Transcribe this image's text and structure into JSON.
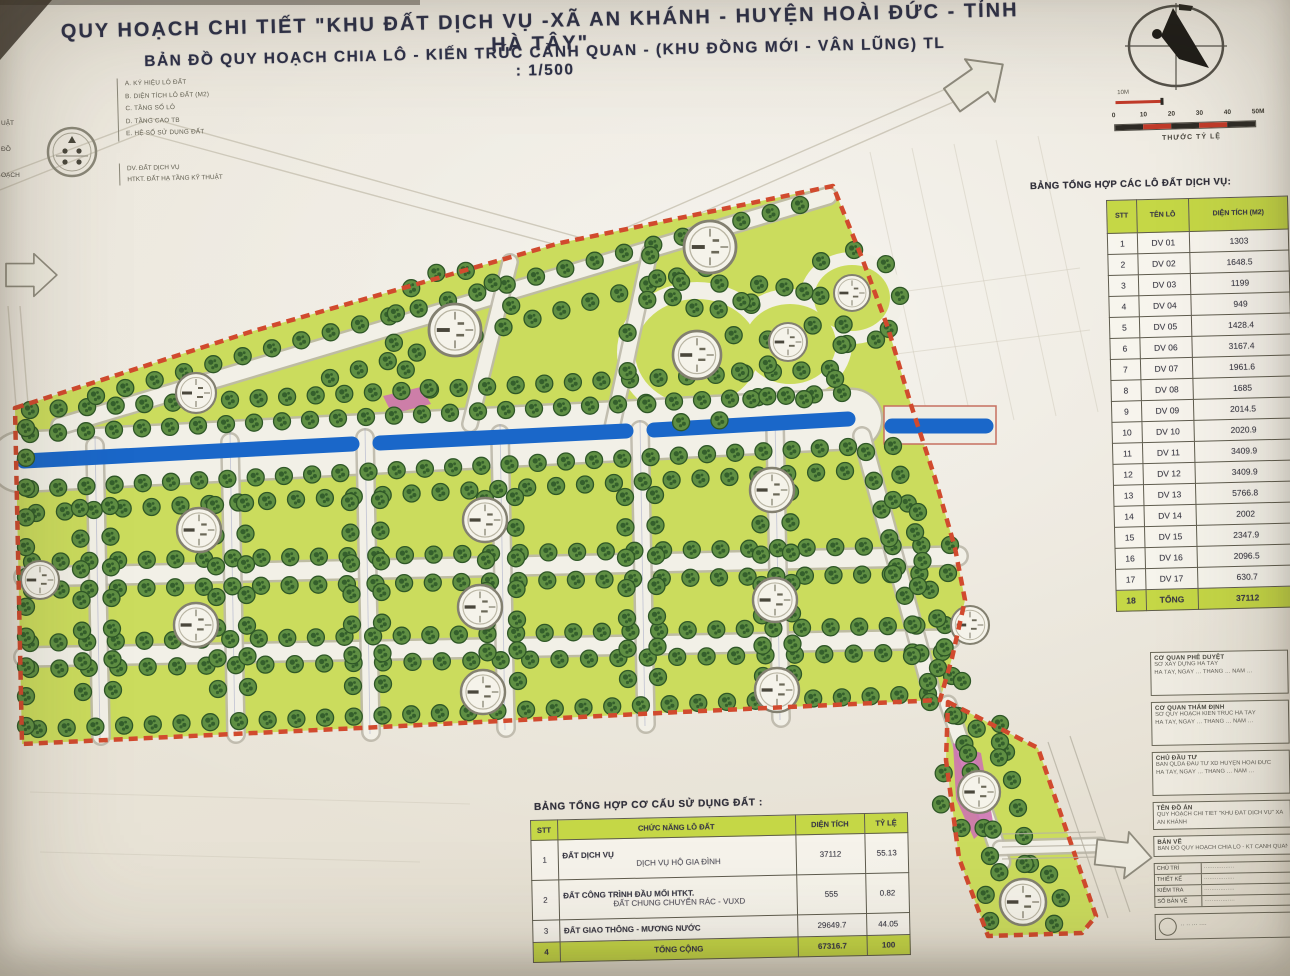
{
  "title": {
    "line1": "QUY HOẠCH CHI TIẾT \"KHU ĐẤT DỊCH VỤ -XÃ AN KHÁNH - HUYỆN HOÀI ĐỨC - TỈNH HÀ TÂY\"",
    "line2": "BẢN ĐỒ QUY HOẠCH CHIA LÔ - KIẾN TRÚC CẢNH QUAN - (KHU ĐỒNG MỚI - VÂN LŨNG)  TL : 1/500"
  },
  "legend": {
    "items": [
      "A. KÝ HIỆU LÔ ĐẤT",
      "B. DIỆN TÍCH LÔ ĐẤT (M2)",
      "C. TẦNG SỐ LÔ",
      "D. TẦNG CAO TB",
      "E. HỆ SỐ SỬ DỤNG ĐẤT"
    ],
    "notes": [
      "DV. ĐẤT DỊCH VỤ",
      "HTKT. ĐẤT HẠ TẦNG KỸ THUẬT"
    ],
    "edge_fragments": [
      "UẬT",
      "ĐỒ",
      "OẠCH"
    ]
  },
  "scalebar": {
    "small_label": "10M",
    "ticks": [
      "0",
      "10",
      "20",
      "30",
      "40",
      "50M"
    ],
    "caption": "THƯỚC TỶ LỆ"
  },
  "right_table": {
    "title": "BẢNG TỔNG HỢP CÁC LÔ ĐẤT DỊCH VỤ:",
    "columns": [
      "STT",
      "TÊN LÔ",
      "DIỆN TÍCH (M2)"
    ],
    "rows": [
      [
        "1",
        "DV 01",
        "1303"
      ],
      [
        "2",
        "DV 02",
        "1648.5"
      ],
      [
        "3",
        "DV 03",
        "1199"
      ],
      [
        "4",
        "DV 04",
        "949"
      ],
      [
        "5",
        "DV 05",
        "1428.4"
      ],
      [
        "6",
        "DV 06",
        "3167.4"
      ],
      [
        "7",
        "DV 07",
        "1961.6"
      ],
      [
        "8",
        "DV 08",
        "1685"
      ],
      [
        "9",
        "DV 09",
        "2014.5"
      ],
      [
        "10",
        "DV 10",
        "2020.9"
      ],
      [
        "11",
        "DV 11",
        "3409.9"
      ],
      [
        "12",
        "DV 12",
        "3409.9"
      ],
      [
        "13",
        "DV 13",
        "5766.8"
      ],
      [
        "14",
        "DV 14",
        "2002"
      ],
      [
        "15",
        "DV 15",
        "2347.9"
      ],
      [
        "16",
        "DV 16",
        "2096.5"
      ],
      [
        "17",
        "DV 17",
        "630.7"
      ]
    ],
    "total_row": [
      "18",
      "TỔNG",
      "37112"
    ]
  },
  "bottom_table": {
    "title": "BẢNG TỔNG HỢP CƠ CẤU  SỬ DỤNG ĐẤT :",
    "columns": [
      "STT",
      "CHỨC NĂNG LÔ ĐẤT",
      "DIỆN TÍCH",
      "TỶ LỆ"
    ],
    "rows": [
      {
        "stt": "1",
        "label": "ĐẤT DỊCH VỤ",
        "sub": "DỊCH VỤ HỘ GIA ĐÌNH",
        "area": "37112",
        "pct": "55.13"
      },
      {
        "stt": "2",
        "label": "ĐẤT CÔNG TRÌNH ĐẦU MỐI HTKT.",
        "sub": "ĐẤT CHUNG CHUYỂN RÁC - VUXD",
        "area": "555",
        "pct": "0.82"
      },
      {
        "stt": "3",
        "label": "ĐẤT GIAO THÔNG - MƯƠNG NƯỚC",
        "sub": "",
        "area": "29649.7",
        "pct": "44.05"
      }
    ],
    "total_row": {
      "stt": "4",
      "label": "TỔNG CỘNG",
      "area": "67316.7",
      "pct": "100"
    }
  },
  "title_block": {
    "sections": [
      {
        "h": "CƠ QUAN PHÊ DUYỆT",
        "l2": "SỞ XÂY DỰNG HÀ TÂY",
        "l3": "HÀ TÂY, NGÀY … THÁNG … NĂM …"
      },
      {
        "h": "CƠ QUAN THẨM ĐỊNH",
        "l2": "SỞ QUY HOẠCH KIẾN TRÚC HÀ TÂY",
        "l3": "HÀ TÂY, NGÀY … THÁNG … NĂM …"
      },
      {
        "h": "CHỦ ĐẦU TƯ",
        "l2": "BAN QLDA ĐẦU TƯ XD HUYỆN HOÀI ĐỨC",
        "l3": "HÀ TÂY, NGÀY … THÁNG … NĂM …"
      }
    ],
    "project": {
      "label": "TÊN ĐỒ ÁN",
      "value": "QUY HOẠCH CHI TIẾT \"KHU ĐẤT DỊCH VỤ\" XÃ AN KHÁNH"
    },
    "drawing": {
      "label": "BẢN VẼ",
      "value": "BẢN ĐỒ QUY HOẠCH CHIA LÔ - KT CẢNH QUAN"
    },
    "staff": [
      [
        "CHỦ TRÌ",
        "·················"
      ],
      [
        "THIẾT KẾ",
        "·················"
      ],
      [
        "KIỂM TRA",
        "·················"
      ],
      [
        "SỐ BẢN VẼ",
        "·················"
      ]
    ],
    "footer": "·· ·· ··· ····"
  },
  "colors": {
    "lot_green": "#cbdd58",
    "canal_blue": "#1767cd",
    "boundary_red": "#d6492c",
    "tree_green": "#5e9040",
    "pink": "#cf6fb4",
    "table_green": "#c5d746",
    "road_white": "#f2f0e7",
    "casing": "#bdb9aa",
    "faint": "#cfc9ba"
  },
  "map": {
    "outside_lines": [
      [
        598,
        240,
        948,
        88
      ],
      [
        612,
        252,
        958,
        100
      ],
      [
        150,
        118,
        596,
        242
      ],
      [
        140,
        132,
        590,
        254
      ],
      [
        0,
        176,
        148,
        120
      ],
      [
        0,
        190,
        140,
        134
      ],
      [
        8,
        306,
        16,
        406
      ],
      [
        20,
        306,
        28,
        404
      ]
    ],
    "grid_lines": [
      [
        870,
        152,
        930,
        428
      ],
      [
        912,
        148,
        972,
        424
      ],
      [
        954,
        144,
        1014,
        420
      ],
      [
        996,
        140,
        1056,
        416
      ],
      [
        1038,
        136,
        1098,
        412
      ],
      [
        840,
        300,
        1080,
        268
      ],
      [
        848,
        360,
        1090,
        330
      ],
      [
        30,
        792,
        470,
        804
      ],
      [
        40,
        852,
        420,
        862
      ]
    ],
    "parcels": [
      "15,408 250,332 560,243 833,186 862,258 888,328 912,408 935,478 955,548 965,600 952,658 940,700 680,712 360,728 22,744",
      "948,702 1038,748 1096,916 1082,933 988,936 959,858 946,760"
    ],
    "white_ovals": [
      [
        697,
        352,
        80,
        70
      ],
      [
        790,
        344,
        62,
        55
      ],
      [
        852,
        298,
        52,
        46
      ]
    ],
    "green_ovals": [
      [
        697,
        352,
        62,
        53
      ],
      [
        790,
        344,
        46,
        40
      ],
      [
        852,
        298,
        38,
        33
      ]
    ],
    "roads": [
      {
        "x1": 20,
        "y1": 462,
        "x2": 852,
        "y2": 419,
        "w": 58
      },
      {
        "x1": 24,
        "y1": 577,
        "x2": 958,
        "y2": 556,
        "w": 17
      },
      {
        "x1": 24,
        "y1": 657,
        "x2": 950,
        "y2": 639,
        "w": 17
      },
      {
        "x1": 60,
        "y1": 426,
        "x2": 828,
        "y2": 196,
        "w": 15
      },
      {
        "x1": 95,
        "y1": 446,
        "x2": 101,
        "y2": 736,
        "w": 15
      },
      {
        "x1": 230,
        "y1": 442,
        "x2": 236,
        "y2": 734,
        "w": 15
      },
      {
        "x1": 365,
        "y1": 438,
        "x2": 371,
        "y2": 732,
        "w": 15
      },
      {
        "x1": 500,
        "y1": 434,
        "x2": 506,
        "y2": 728,
        "w": 15
      },
      {
        "x1": 640,
        "y1": 430,
        "x2": 646,
        "y2": 724,
        "w": 15
      },
      {
        "x1": 775,
        "y1": 426,
        "x2": 781,
        "y2": 718,
        "w": 15
      },
      {
        "x1": 470,
        "y1": 424,
        "x2": 510,
        "y2": 262,
        "w": 13
      },
      {
        "x1": 612,
        "y1": 428,
        "x2": 650,
        "y2": 252,
        "w": 13
      },
      {
        "x1": 862,
        "y1": 436,
        "x2": 932,
        "y2": 694,
        "w": 15
      },
      {
        "x1": 948,
        "y1": 704,
        "x2": 1002,
        "y2": 862,
        "w": 14
      },
      {
        "x1": 1000,
        "y1": 848,
        "x2": 1100,
        "y2": 845,
        "w": 12
      }
    ],
    "lot_lines": [
      [
        95,
        436,
        100,
        738
      ],
      [
        230,
        432,
        235,
        736
      ],
      [
        365,
        428,
        370,
        734
      ],
      [
        500,
        424,
        505,
        730
      ],
      [
        640,
        420,
        645,
        726
      ],
      [
        775,
        416,
        780,
        720
      ]
    ],
    "canal_rect": {
      "x": 884,
      "y": 406,
      "w": 112,
      "h": 38
    },
    "canals": [
      [
        24,
        461,
        352,
        444
      ],
      [
        380,
        443,
        626,
        431
      ],
      [
        654,
        430,
        848,
        419
      ],
      [
        892,
        426,
        986,
        426
      ]
    ],
    "pink": [
      "383,396 421,387 431,404 392,414",
      "953,743 981,753 993,822 974,839 956,799"
    ],
    "tree_rows": [
      [
        30,
        434,
        842,
        393,
        30
      ],
      [
        30,
        410,
        830,
        369,
        29
      ],
      [
        30,
        489,
        848,
        447,
        30
      ],
      [
        36,
        513,
        845,
        471,
        29
      ],
      [
        32,
        562,
        950,
        545,
        33
      ],
      [
        32,
        590,
        948,
        573,
        33
      ],
      [
        30,
        643,
        945,
        625,
        33
      ],
      [
        30,
        669,
        942,
        652,
        32
      ],
      [
        38,
        729,
        928,
        694,
        32
      ],
      [
        26,
        428,
        26,
        726,
        11
      ],
      [
        96,
        396,
        800,
        205,
        25
      ],
      [
        330,
        378,
        706,
        268,
        14
      ],
      [
        866,
        452,
        928,
        682,
        9
      ],
      [
        893,
        446,
        952,
        676,
        9
      ],
      [
        958,
        716,
        990,
        856,
        6
      ],
      [
        1000,
        724,
        1030,
        864,
        6
      ],
      [
        930,
        702,
        1000,
        742,
        4
      ],
      [
        80,
        508,
        83,
        692,
        7
      ],
      [
        110,
        506,
        113,
        690,
        7
      ],
      [
        215,
        505,
        218,
        689,
        7
      ],
      [
        245,
        503,
        248,
        687,
        7
      ],
      [
        350,
        502,
        353,
        686,
        7
      ],
      [
        380,
        500,
        383,
        684,
        7
      ],
      [
        485,
        499,
        488,
        683,
        7
      ],
      [
        515,
        497,
        518,
        681,
        7
      ],
      [
        625,
        497,
        628,
        679,
        7
      ],
      [
        655,
        495,
        658,
        677,
        7
      ],
      [
        760,
        494,
        763,
        676,
        7
      ],
      [
        790,
        492,
        793,
        674,
        7
      ]
    ],
    "tree_rings": [
      [
        697,
        352,
        72,
        10,
        350,
        12
      ],
      [
        790,
        344,
        57,
        0,
        340,
        10
      ],
      [
        852,
        298,
        48,
        60,
        400,
        9
      ],
      [
        710,
        250,
        60,
        35,
        175,
        7
      ],
      [
        455,
        332,
        62,
        115,
        335,
        9
      ],
      [
        1023,
        902,
        38,
        150,
        395,
        7
      ],
      [
        979,
        792,
        40,
        70,
        300,
        6
      ]
    ],
    "trees_single": [
      [
        912,
        656
      ],
      [
        938,
        668
      ],
      [
        962,
        681
      ],
      [
        893,
        574
      ],
      [
        918,
        586
      ],
      [
        893,
        500
      ],
      [
        918,
        512
      ]
    ],
    "lot_circles": [
      [
        196,
        393,
        20
      ],
      [
        199,
        530,
        22
      ],
      [
        196,
        625,
        22
      ],
      [
        40,
        580,
        19
      ],
      [
        455,
        330,
        26
      ],
      [
        485,
        520,
        22
      ],
      [
        480,
        607,
        22
      ],
      [
        483,
        692,
        22
      ],
      [
        710,
        247,
        26
      ],
      [
        697,
        355,
        24
      ],
      [
        788,
        342,
        19
      ],
      [
        852,
        293,
        18
      ],
      [
        772,
        490,
        22
      ],
      [
        775,
        600,
        22
      ],
      [
        777,
        690,
        22
      ],
      [
        970,
        625,
        19
      ],
      [
        979,
        792,
        21
      ],
      [
        1023,
        902,
        23
      ]
    ],
    "hatches": [
      [
        1002,
        834,
        1096,
        832
      ],
      [
        1002,
        847,
        1096,
        845
      ],
      [
        1002,
        859,
        1096,
        857
      ],
      [
        1048,
        742,
        1108,
        918
      ],
      [
        1070,
        736,
        1130,
        912
      ]
    ],
    "arrows": [
      {
        "x": 6,
        "y": 275,
        "r": 0,
        "s": 0.82
      },
      {
        "x": 952,
        "y": 100,
        "r": -35,
        "s": 1.0
      },
      {
        "x": 1096,
        "y": 852,
        "r": 6,
        "s": 0.9
      }
    ]
  }
}
